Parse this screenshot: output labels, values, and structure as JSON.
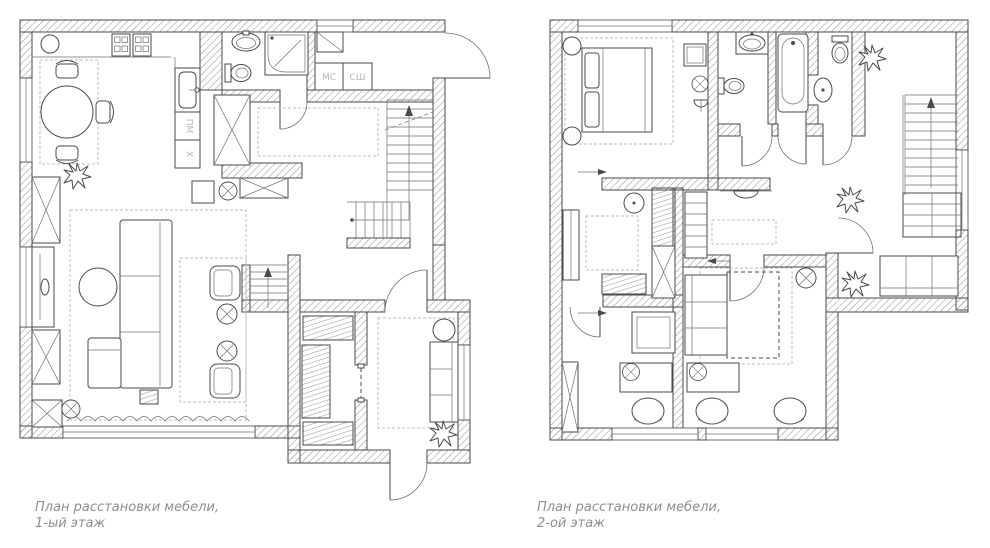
{
  "colors": {
    "line": "#4a4a4a",
    "wall_hatch": "#909090",
    "appliance_label": "#b5b5b5",
    "caption": "#8e8e8e",
    "background": "#ffffff"
  },
  "floor1": {
    "caption_line1": "План расстановки мебели,",
    "caption_line2": "1-ый этаж",
    "labels": {
      "washing_machine": "МС",
      "drying_cabinet": "СШ",
      "dishwasher": "ПМ",
      "fridge": "X"
    }
  },
  "floor2": {
    "caption_line1": "План расстановки мебели,",
    "caption_line2": "2-ой этаж"
  }
}
